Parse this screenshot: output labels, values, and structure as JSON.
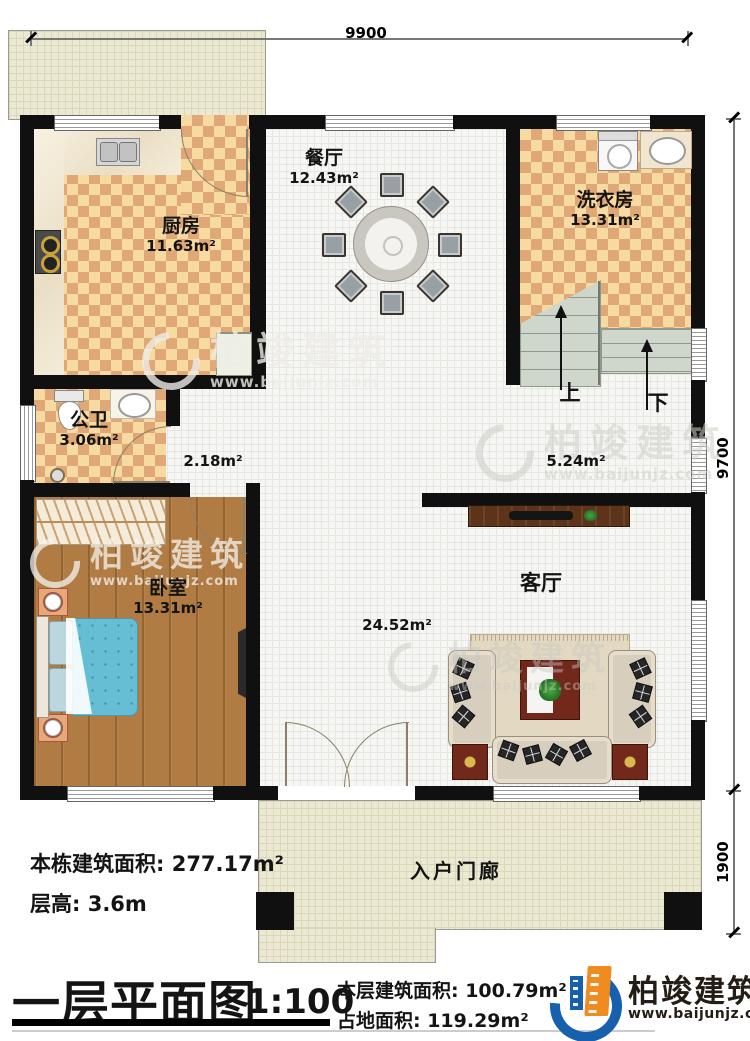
{
  "dimensions": {
    "top": "9900",
    "side_upper": "9700",
    "side_lower": "1900"
  },
  "rooms": {
    "kitchen": {
      "name": "厨房",
      "area": "11.63m²"
    },
    "dining": {
      "name": "餐厅",
      "area": "12.43m²"
    },
    "laundry": {
      "name": "洗衣房",
      "area": "13.31m²"
    },
    "bathroom": {
      "name": "公卫",
      "area": "3.06m²"
    },
    "corridor": {
      "area": "2.18m²"
    },
    "stair_hall": {
      "area": "5.24m²"
    },
    "bedroom": {
      "name": "卧室",
      "area": "13.31m²"
    },
    "living": {
      "name": "客厅",
      "area": "24.52m²"
    },
    "porch": {
      "name": "入户门廊"
    }
  },
  "stairs": {
    "up_label": "上",
    "down_label": "下"
  },
  "notes": {
    "total_area": "本栋建筑面积: 277.17m²",
    "floor_height": "层高: 3.6m"
  },
  "titlebar": {
    "title": "一层平面图",
    "scale": "1:100",
    "floor_area": "本层建筑面积: 100.79m²",
    "footprint": "占地面积: 119.29m²"
  },
  "brand": {
    "name": "柏竣建筑",
    "url": "www.baijunjz.com"
  },
  "watermark": {
    "name": "柏竣建筑",
    "url": "www.baijunjz.com"
  },
  "colors": {
    "wall": "#101010",
    "checker_light": "#f7d9a2",
    "checker_dark": "#dfa876",
    "wood": "#b07c44",
    "porch_beige": "#ece9d2",
    "stair_gray": "#cfd6cb",
    "brand_blue": "#1660ad",
    "brand_orange": "#f08c1f"
  }
}
